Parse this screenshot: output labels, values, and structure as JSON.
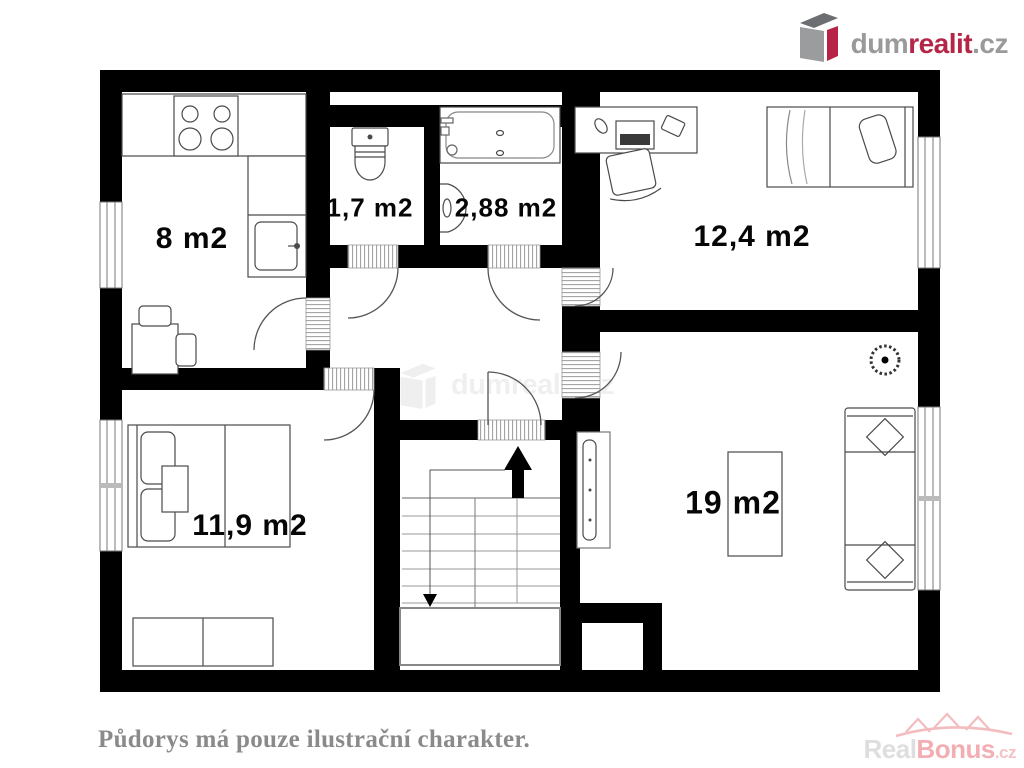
{
  "logo": {
    "prefix": "dum",
    "accent": "realit",
    "suffix": ".cz"
  },
  "caption": "Půdorys má pouze ilustrační charakter.",
  "plan": {
    "rooms": [
      {
        "name": "kitchen",
        "area_label": "8 m2"
      },
      {
        "name": "wc",
        "area_label": "1,7 m2"
      },
      {
        "name": "bathroom",
        "area_label": "2,88 m2"
      },
      {
        "name": "bedroom-top-right",
        "area_label": "12,4 m2"
      },
      {
        "name": "bedroom-bottom-left",
        "area_label": "11,9 m2"
      },
      {
        "name": "living-room",
        "area_label": "19 m2"
      }
    ]
  },
  "watermark_center": {
    "text": "dumrealit.cz"
  },
  "watermark_bottom_right": {
    "prefix": "Real",
    "accent": "Bonus",
    "suffix": ".cz"
  },
  "icons": {
    "logo-box-icon": "3d-house-box",
    "houses-icon": "three-house-outlines",
    "up-arrow-icon": "stairs-up-arrow",
    "down-arrow-icon": "stairs-down-arrow"
  },
  "colors": {
    "wall_black": "#000000",
    "logo_gray": "#9a9a9a",
    "logo_red": "#b42647",
    "caption_gray": "#8a8a8a",
    "watermark_pink": "#f2aeb3",
    "furniture_stroke": "#4a4a4a"
  }
}
